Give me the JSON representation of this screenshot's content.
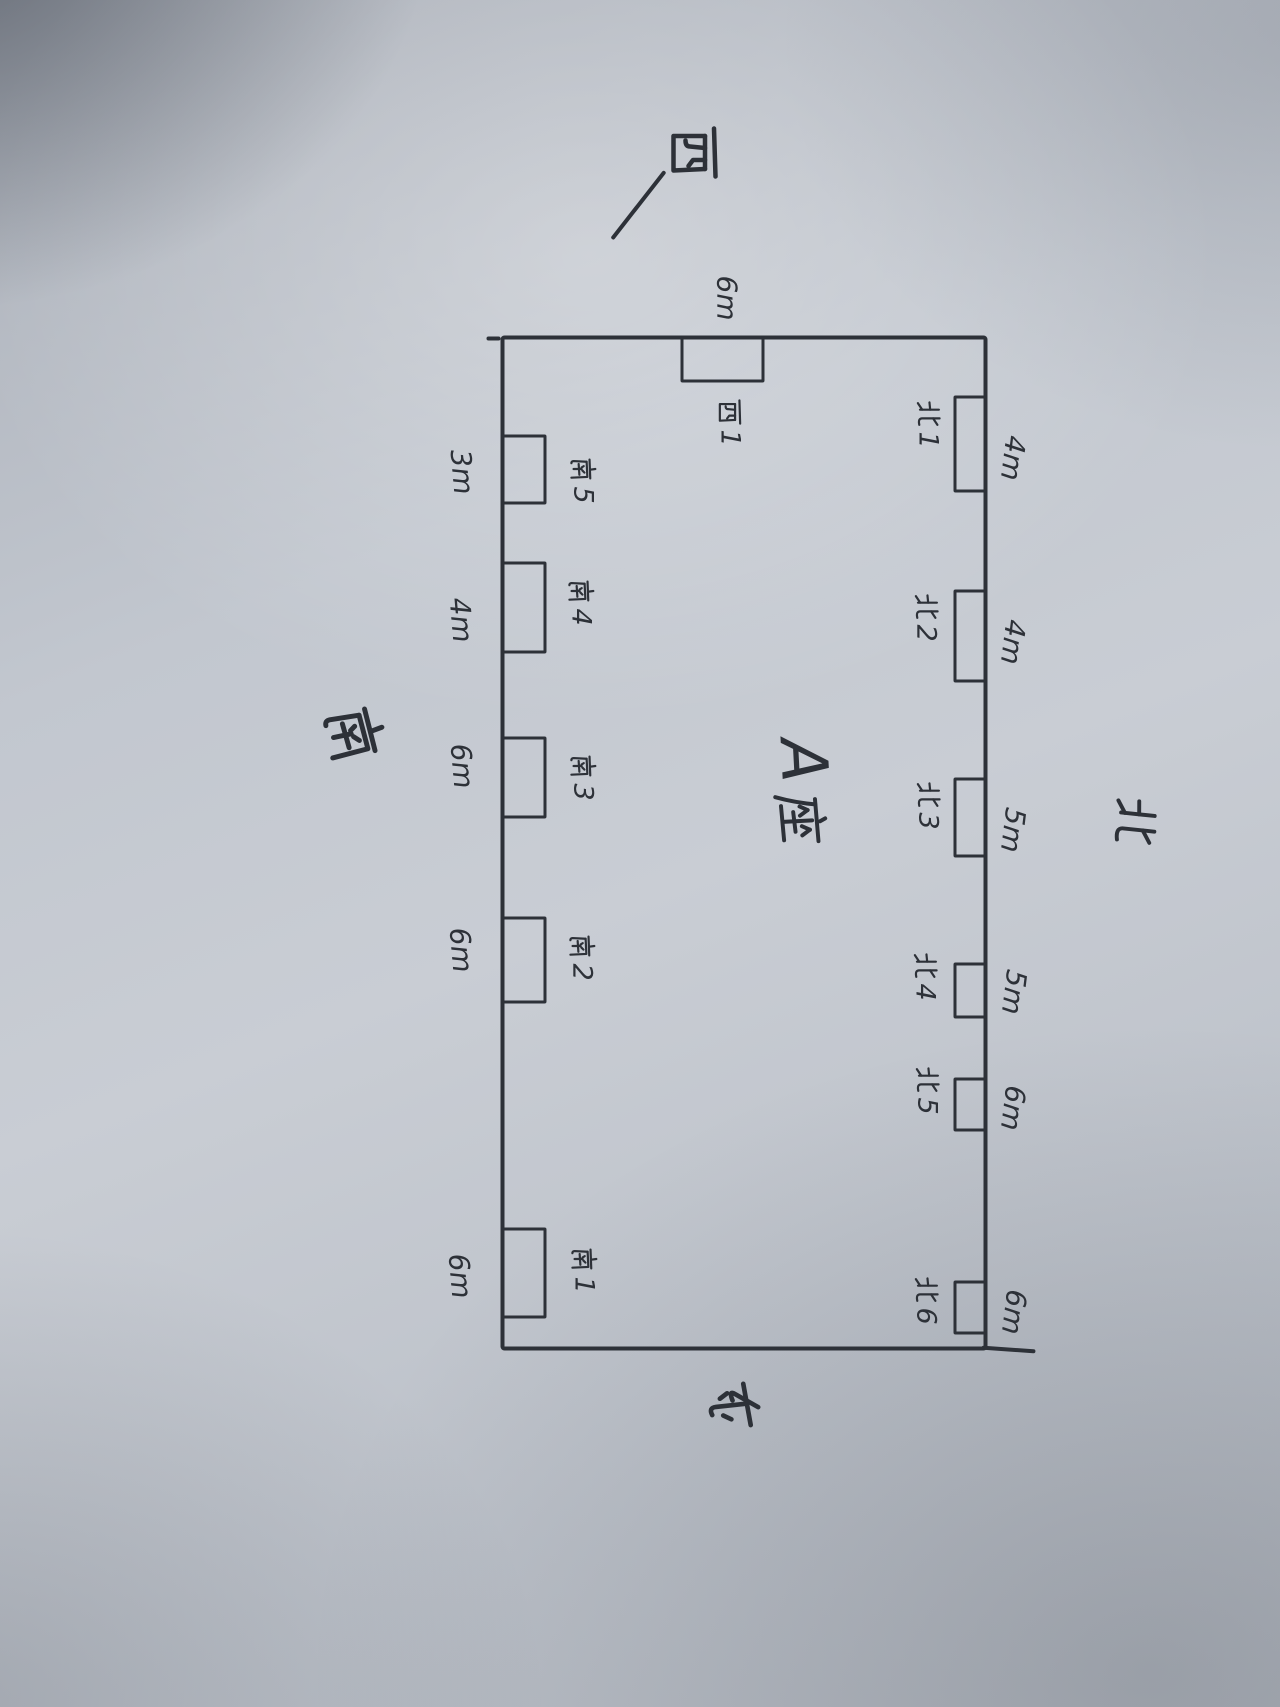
{
  "plan": {
    "center_label": {
      "letter": "A",
      "char": "座",
      "full": "A座"
    },
    "compass": {
      "north": "北",
      "south": "南",
      "west": "西",
      "east": "东"
    },
    "north_wall": {
      "name": "北",
      "windows": [
        {
          "label": "北1",
          "char": "北",
          "number": "1",
          "width": "4m"
        },
        {
          "label": "北2",
          "char": "北",
          "number": "2",
          "width": "4m"
        },
        {
          "label": "北3",
          "char": "北",
          "number": "3",
          "width": "5m"
        },
        {
          "label": "北4",
          "char": "北",
          "number": "4",
          "width": "5m"
        },
        {
          "label": "北5",
          "char": "北",
          "number": "5",
          "width": "6m"
        },
        {
          "label": "北6",
          "char": "北",
          "number": "6",
          "width": "6m"
        }
      ]
    },
    "south_wall": {
      "name": "南",
      "windows": [
        {
          "label": "南5",
          "char": "南",
          "number": "5",
          "width": "3m"
        },
        {
          "label": "南4",
          "char": "南",
          "number": "4",
          "width": "4m"
        },
        {
          "label": "南3",
          "char": "南",
          "number": "3",
          "width": "6m"
        },
        {
          "label": "南2",
          "char": "南",
          "number": "2",
          "width": "6m"
        },
        {
          "label": "南1",
          "char": "南",
          "number": "1",
          "width": "6m"
        }
      ]
    },
    "west_wall": {
      "name": "西",
      "windows": [
        {
          "label": "西1",
          "char": "西",
          "number": "1",
          "width": "6m"
        }
      ]
    },
    "east_wall": {
      "name": "东",
      "windows": []
    }
  }
}
